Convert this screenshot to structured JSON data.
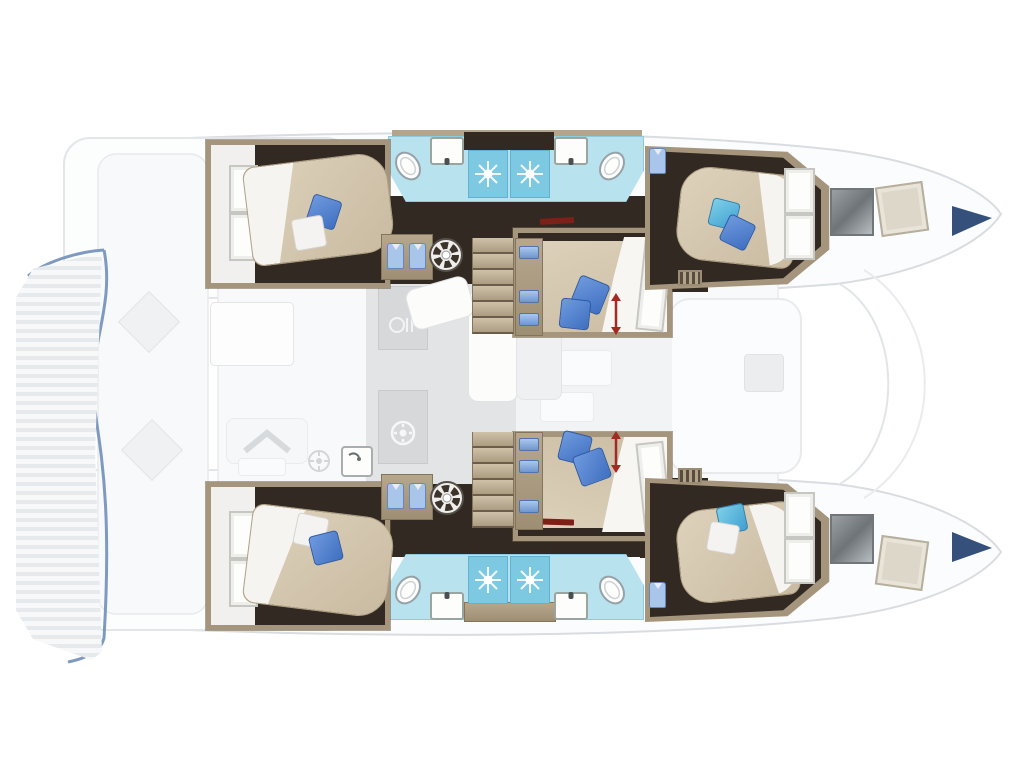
{
  "diagram": {
    "type": "floor-plan",
    "subject": "catamaran-yacht-interior-layout-top-view",
    "hulls": 2,
    "rooms": [
      {
        "id": "upper-left-cabin",
        "kind": "double-cabin",
        "features": [
          "angled-double-bed",
          "blue-pillow",
          "white-pillow",
          "double-door",
          "wardrobe-2-shirts",
          "washing-machine"
        ]
      },
      {
        "id": "upper-bathroom-left",
        "kind": "bathroom",
        "features": [
          "toilet",
          "sink",
          "shower-stall"
        ]
      },
      {
        "id": "upper-bathroom-right",
        "kind": "bathroom",
        "features": [
          "toilet",
          "sink",
          "shower-stall"
        ]
      },
      {
        "id": "upper-right-cabin",
        "kind": "double-cabin",
        "features": [
          "angled-double-bed",
          "teal-pillow",
          "blue-pillow",
          "double-door",
          "shirt-locker",
          "vent-grille",
          "hull-window",
          "deck-hatch"
        ]
      },
      {
        "id": "center-upper-cabin",
        "kind": "convertible-double-cabin",
        "features": [
          "island-bed",
          "two-blue-pillows",
          "white-duvet",
          "bifold-door",
          "shelf-column-3-towels",
          "red-adjust-arrow",
          "red-wall-marker",
          "companionway-stairs"
        ]
      },
      {
        "id": "saloon-galley",
        "kind": "saloon",
        "features": [
          "l-shaped-white-sofa",
          "galley-counters",
          "cooktop-burner",
          "galley-sink",
          "grey-floor"
        ]
      },
      {
        "id": "center-lower-cabin",
        "kind": "convertible-double-cabin",
        "features": [
          "island-bed",
          "two-blue-pillows",
          "white-duvet",
          "bifold-door",
          "shelf-column-3-towels",
          "red-adjust-arrow",
          "red-wall-marker",
          "companionway-stairs"
        ]
      },
      {
        "id": "lower-left-cabin",
        "kind": "double-cabin",
        "features": [
          "angled-double-bed",
          "white-pillow",
          "blue-pillow",
          "double-door",
          "wardrobe-2-shirts",
          "washing-machine"
        ]
      },
      {
        "id": "lower-bathroom-left",
        "kind": "bathroom",
        "features": [
          "toilet",
          "sink",
          "shower-stall"
        ]
      },
      {
        "id": "lower-bathroom-right",
        "kind": "bathroom",
        "features": [
          "toilet",
          "sink",
          "shower-stall"
        ]
      },
      {
        "id": "lower-right-cabin",
        "kind": "double-cabin",
        "features": [
          "angled-double-bed",
          "teal-pillow",
          "white-pillow",
          "double-door",
          "shirt-locker",
          "vent-grille",
          "hull-window",
          "deck-hatch"
        ]
      },
      {
        "id": "outer-deck",
        "kind": "exterior-ghosted",
        "features": [
          "slatted-platform",
          "diamond-tables",
          "white-dining-table",
          "chevron-bench",
          "forward-seating-pod",
          "grill-burner",
          "hull-tip-fenders"
        ]
      }
    ],
    "counts": {
      "cabins": 6,
      "bathrooms": 4,
      "shower-stalls": 4,
      "washing-machines": 2,
      "stair-flights": 2
    },
    "colors": {
      "wood": "#a4957c",
      "wood_dark": "#7c6e58",
      "floor_dark": "#322a22",
      "aqua": "#b7e2ee",
      "shower": "#7ec9e2",
      "saloon": "#e3e4e6",
      "counter": "#d7d8da",
      "pillow": "#4a7fd0",
      "shirt": "#a9c5ea",
      "shirt_line": "#6488bb",
      "red": "#a62e24",
      "red_dark": "#7e2018",
      "navy": "#35507b",
      "tramp_line": "#7e9ac0",
      "ghost_line": "#e3e6e9",
      "ghost_fill": "#fbfcfd",
      "hull_line": "#d9dde0"
    }
  }
}
